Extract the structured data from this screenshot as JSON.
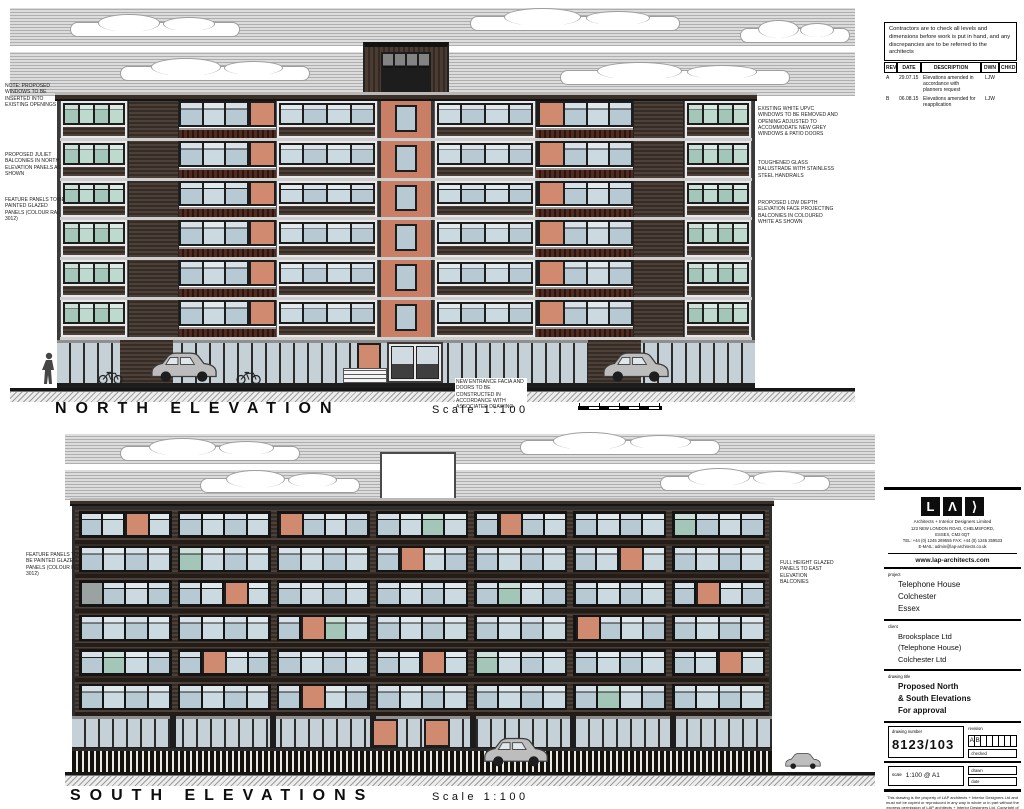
{
  "colors": {
    "glass_blue": "#b7c9d3",
    "glass_blue2": "#cbd9e0",
    "glass_teal": "#a3c6b9",
    "glass_teal2": "#bedacf",
    "salmon": "#d08a70",
    "salmon2": "#c97f66",
    "gray_panel": "#9aa3a1",
    "brick_dark": "#4c4039",
    "brick_line": "#352c26",
    "balustrade": "#512a20",
    "balustrade_line": "#2c150e",
    "surround": "#e9e9e9",
    "slab": "#cfcfcf"
  },
  "north": {
    "title": "NORTH ELEVATION",
    "scale": "Scale 1:100",
    "annotations_left": [
      "NOTE: PROPOSED WINDOWS TO BE INSERTED INTO EXISTING OPENINGS",
      "PROPOSED JULIET BALCONIES IN NORTH ELEVATION PANELS AS SHOWN",
      "FEATURE PANELS TO BE PAINTED GLAZED PANELS (COLOUR RAL 3012)"
    ],
    "annotations_right": [
      "EXISTING WHITE UPVC WINDOWS TO BE REMOVED AND OPENING ADJUSTED TO ACCOMMODATE NEW GREY WINDOWS & PATIO DOORS",
      "TOUGHENED GLASS BALUSTRADE WITH STAINLESS STEEL HANDRAILS",
      "PROPOSED LOW DEPTH ELEVATION FACE PROJECTING BALCONIES IN COLOURED WHITE AS SHOWN"
    ],
    "entrance_note": "NEW ENTRANCE FACIA AND DOORS TO BE CONSTRUCTED IN ACCORDANCE WITH ASSOCIATED DRAWING",
    "building": {
      "floors": 6,
      "bays": [
        {
          "t": "win",
          "g": "teal",
          "w": 9
        },
        {
          "t": "pier",
          "w": 7
        },
        {
          "t": "balc",
          "w": 14
        },
        {
          "t": "win",
          "g": "blue",
          "w": 14
        },
        {
          "t": "core",
          "w": 8
        },
        {
          "t": "win",
          "g": "blue",
          "w": 14
        },
        {
          "t": "balc",
          "w": 14,
          "m": true
        },
        {
          "t": "pier",
          "w": 7
        },
        {
          "t": "win",
          "g": "teal",
          "w": 9
        }
      ]
    }
  },
  "south": {
    "title": "SOUTH ELEVATIONS",
    "scale": "Scale 1:100",
    "annotations_left": [
      "FEATURE PANELS TO BE PAINTED GLAZED PANELS (COLOUR RAL 3012)"
    ],
    "annotations_right": [
      "FULL HEIGHT GLAZED PANELS TO EAST ELEVATION BALCONIES"
    ],
    "building": {
      "panes": [
        [
          "bBsB",
          "bBbB",
          "sbBb",
          "bBtB",
          "bsbB",
          "bBbB",
          "tbBb"
        ],
        [
          "bBbB",
          "tBbB",
          "bBbB",
          "bsBb",
          "bBbB",
          "bBsB",
          "bBbB"
        ],
        [
          "gbBb",
          "bBsB",
          "bBbB",
          "bBbB",
          "btBb",
          "bBbB",
          "bsBb"
        ],
        [
          "bBbB",
          "bBbB",
          "bstB",
          "bBbB",
          "bBbB",
          "sbBb",
          "bBbB"
        ],
        [
          "btBb",
          "bsBb",
          "bBbB",
          "bBsB",
          "tBbB",
          "bBbB",
          "bBsB"
        ],
        [
          "bBbB",
          "bBbB",
          "bsBb",
          "bBbB",
          "bBbB",
          "btBb",
          "bBbB"
        ]
      ]
    }
  },
  "notes_box": "Contractors are to check all levels and dimensions before work is put in hand, and any discrepancies are to be referred to the architects",
  "revision_table": {
    "headers": {
      "rev": "REV",
      "date": "DATE",
      "description": "DESCRIPTION",
      "dwn": "DWN",
      "chkd": "CHKD"
    },
    "rows": [
      {
        "rev": "A",
        "date": "29.07.15",
        "description": "Elevations amended in accordance with planners request",
        "dwn": "LJW",
        "chkd": ""
      },
      {
        "rev": "B",
        "date": "06.08.15",
        "description": "Elevations amended for reapplication",
        "dwn": "LJW",
        "chkd": ""
      }
    ]
  },
  "title_block": {
    "logo_letters": [
      "L",
      "Λ",
      "⟩"
    ],
    "firm_line": "Architects + Interior Designers Limited",
    "address_line1": "123 NEW LONDON ROAD, CHELMSFORD,",
    "address_line2": "ESSEX, CM2 0QT",
    "phone_line": "TEL: +44 (0) 1245 269555   FAX: +44 (0) 1245 259533",
    "email_line": "E-MAIL: admin@lap-architects.co.uk",
    "website": "www.lap-architects.com",
    "project_label": "project",
    "project_lines": [
      "Telephone House",
      "Colchester",
      "Essex"
    ],
    "client_label": "client",
    "client_lines": [
      "Brooksplace Ltd",
      "(Telephone House)",
      "Colchester Ltd"
    ],
    "drawing_title_label": "drawing title",
    "drawing_title_lines": [
      "Proposed North",
      "& South Elevations",
      "For approval"
    ],
    "drawing_number_label": "drawing number",
    "drawing_number": "8123/103",
    "revision_label": "revision",
    "revisions": [
      "A",
      "B"
    ],
    "checked_label": "checked",
    "scale_label": "scale",
    "scale_value": "1:100 @ A1",
    "drawn_label": "drawn",
    "date_label": "date",
    "disclaimer": "This drawing is the property of LAP architects + Interior Designers Ltd and must not be copied or reproduced in any way in whole or in part without the express permission of LAP architects + Interior Designers Ltd. Copyright of LAP architects + Interior Designers Ltd."
  }
}
